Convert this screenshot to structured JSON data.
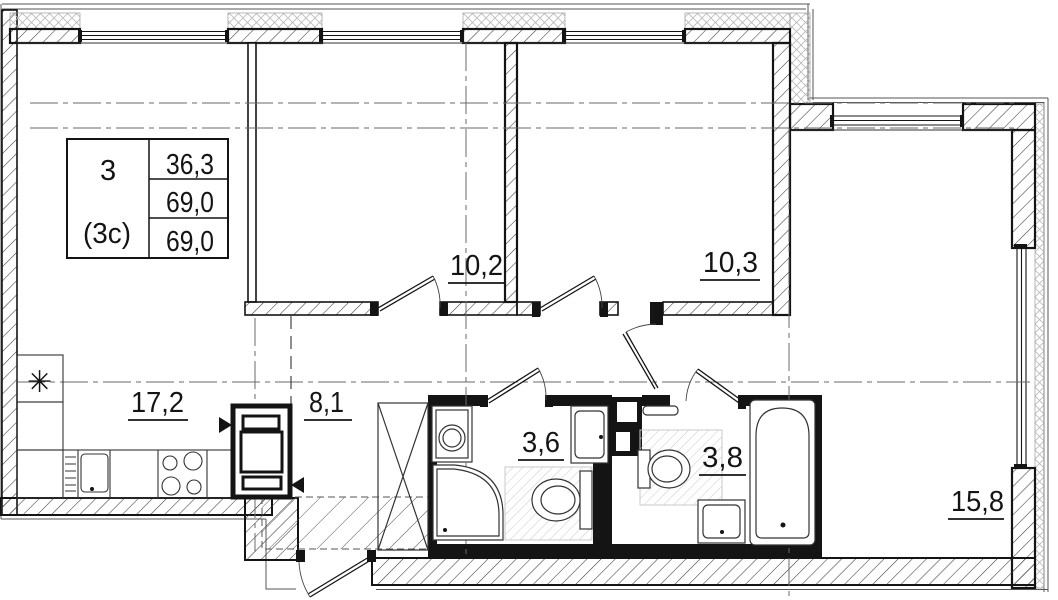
{
  "info_table": {
    "rooms_count": "3",
    "plan_type": "(3с)",
    "living_area": "36,3",
    "total_area": "69,0",
    "total_area_final": "69,0"
  },
  "rooms": {
    "kitchen_living": {
      "area": "17,2"
    },
    "hallway": {
      "area": "8,1"
    },
    "bedroom_1": {
      "area": "10,2"
    },
    "bedroom_2": {
      "area": "10,3"
    },
    "bathroom_1": {
      "area": "3,6"
    },
    "bathroom_2": {
      "area": "3,8"
    },
    "living_room": {
      "area": "15,8"
    }
  },
  "symbols": {
    "fridge": "✳"
  },
  "colors": {
    "line": "#141414",
    "wall_hatch": "#3a3a3a",
    "insulation": "#b8b8b8",
    "floor_hatch": "#c9c9c9",
    "axis": "#6a6a6a"
  }
}
